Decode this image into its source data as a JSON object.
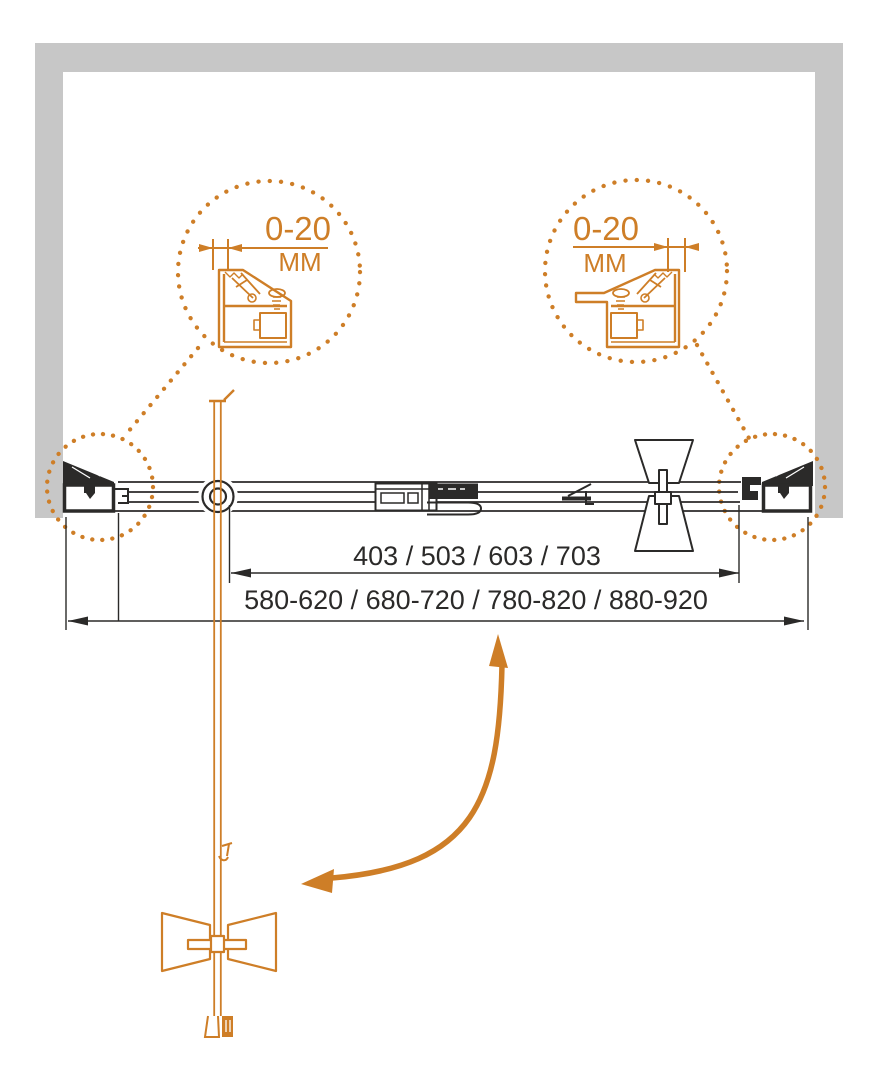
{
  "diagram": {
    "kind": "shower-door installation drawing, plan view",
    "colors": {
      "accent_orange": "#ce7e27",
      "line_black": "#2b2a29",
      "wall_gray": "#c7c7c7"
    },
    "callouts": {
      "left": {
        "value": "0-20",
        "unit": "ММ"
      },
      "right": {
        "value": "0-20",
        "unit": "ММ"
      }
    },
    "dimensions": {
      "glass_width_options": "403 / 503 / 603 / 703",
      "overall_width_options": "580-620 / 680-720 / 780-820 / 880-920"
    }
  }
}
